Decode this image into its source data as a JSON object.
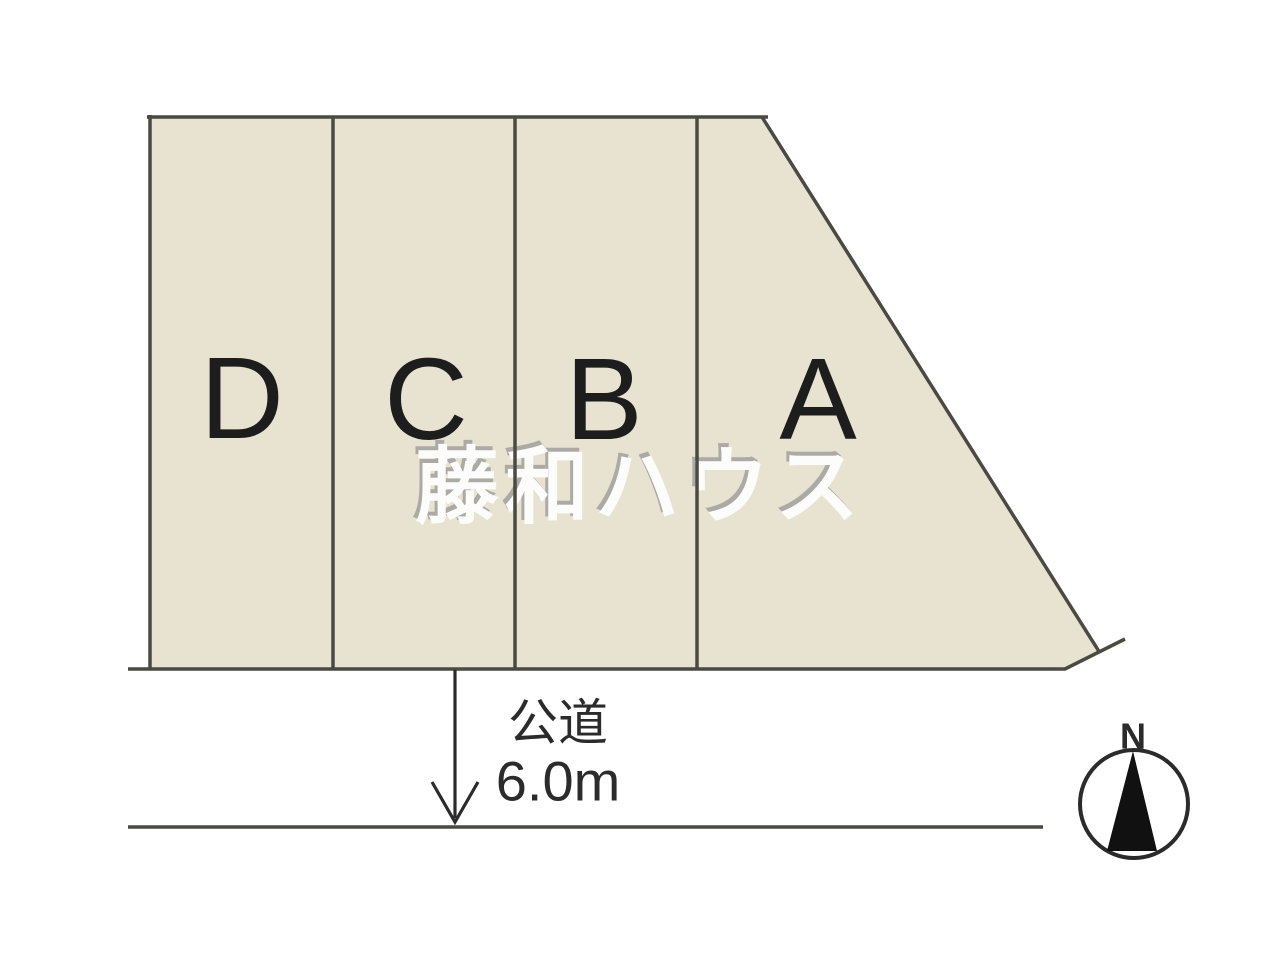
{
  "diagram": {
    "lots": [
      {
        "label": "D"
      },
      {
        "label": "C"
      },
      {
        "label": "B"
      },
      {
        "label": "A"
      }
    ],
    "road": {
      "name": "公道",
      "width": "6.0m"
    },
    "compass": {
      "north": "N"
    },
    "watermark": "藤和ハウス"
  },
  "colors": {
    "background": "#ffffff",
    "lot_fill": "#e8e2d0",
    "line": "#4a4a42",
    "text": "#1d1d1d",
    "annotation": "#2b2b2b",
    "needle": "#111111",
    "watermark_fill": "#fcfcfb",
    "watermark_shadow": "#abaaa5"
  }
}
